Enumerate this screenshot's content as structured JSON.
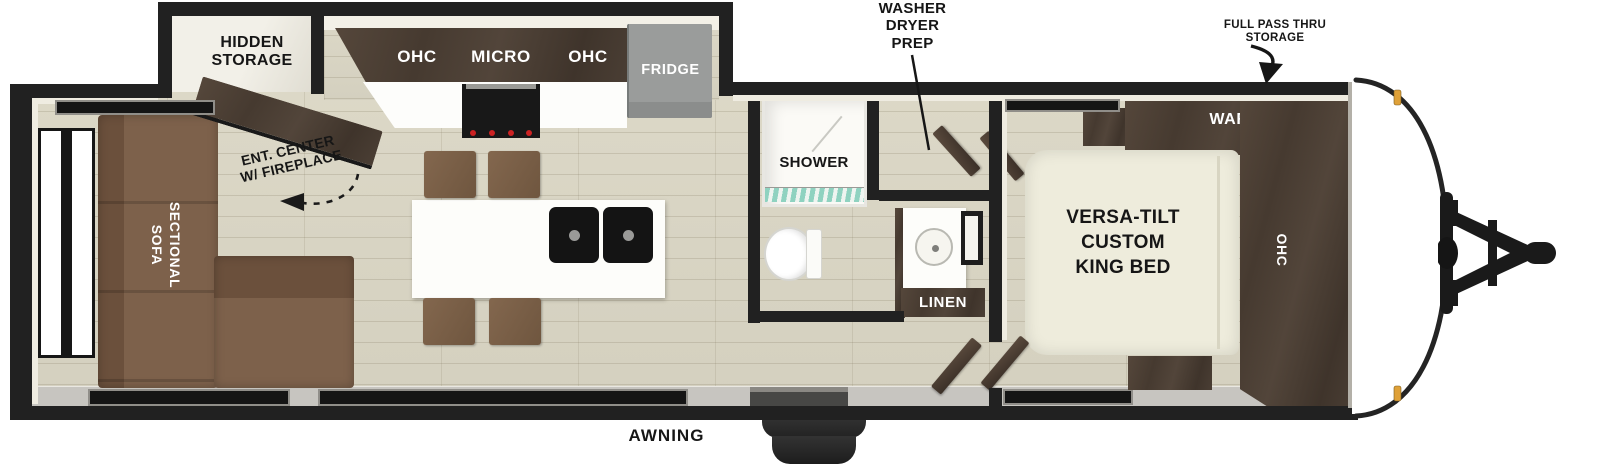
{
  "title": "Travel Trailer Floor Plan",
  "colors": {
    "wall": "#212121",
    "floor": "#d8d4c2",
    "cabinet_wood": "#4c3f34",
    "sofa_brown": "#7d614b",
    "chair_brown": "#7a5e46",
    "fridge_gray": "#9a9c9b",
    "bed_cream": "#eeecdc",
    "island_white": "#ffffff",
    "sink_black": "#141414",
    "shower_tile_teal": "#8fd2c0",
    "clearance_light_amber": "#dfa138",
    "label_black": "#161616",
    "band_gray": "#c7c5c0"
  },
  "callouts": {
    "washer_dryer_prep": "WASHER\nDRYER\nPREP",
    "full_pass_thru_storage": "FULL PASS THRU\nSTORAGE",
    "hidden_storage": "HIDDEN\nSTORAGE",
    "ent_center_w_fireplace": "ENT. CENTER\nW/ FIREPLACE",
    "awning": "AWNING"
  },
  "living_room": {
    "sectional_sofa": "SECTIONAL\nSOFA"
  },
  "kitchen": {
    "ohc_left": "OHC",
    "micro": "MICRO",
    "ohc_right": "OHC",
    "fridge": "FRIDGE"
  },
  "bathroom": {
    "shower": "SHOWER",
    "linen": "LINEN"
  },
  "bedroom": {
    "ward": "WARD",
    "overhead_cabinet": "OHC",
    "king_bed": "VERSA-TILT\nCUSTOM\nKING BED"
  }
}
